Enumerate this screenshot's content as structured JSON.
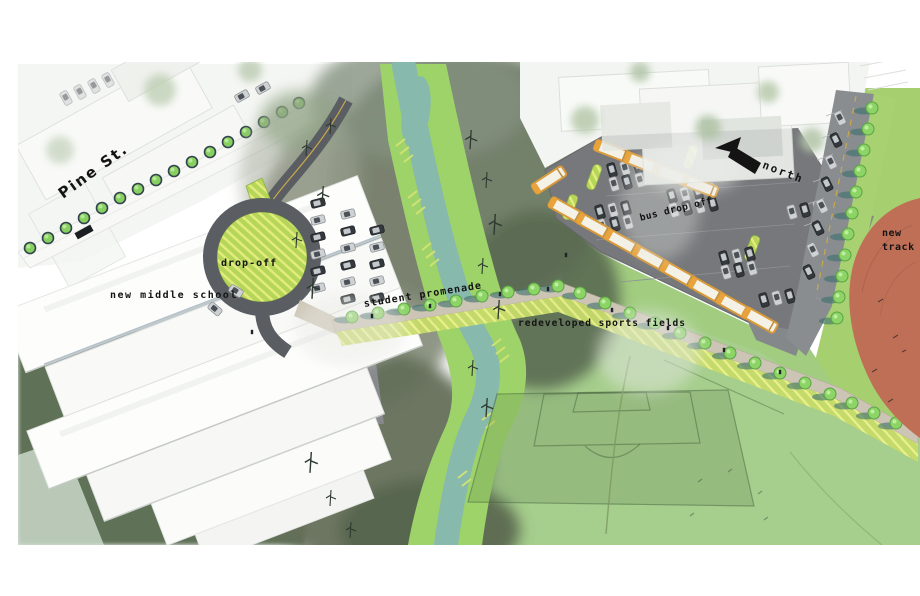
{
  "labels": {
    "pine_st": "Pine St.",
    "new_middle_school": "new middle school",
    "drop_off": "drop-off",
    "student_promenade": "student promenade",
    "bus_drop_off": "bus drop off",
    "north": "north",
    "new_track": "new\ntrack",
    "redeveloped_sports_fields": "redeveloped sports fields"
  },
  "compass": {
    "direction_label": "north",
    "arrow_points": "upper-left"
  },
  "colors": {
    "sports_field_green": "#a6ce8c",
    "stream_bank_green": "#9ed36a",
    "water_teal": "#87b9ac",
    "track_terracotta": "#bf6f56",
    "parking_lot_gray": "#76787b",
    "road_gray": "#5a5e62",
    "bus_yellow": "#d99a3a",
    "street_tree_green": "#86d05f",
    "planting_hatch_green": "#c6db69",
    "promenade_tan": "#ccc4b4",
    "building_white": "#fdfdfc",
    "lawn_olive": "#5f7157"
  }
}
